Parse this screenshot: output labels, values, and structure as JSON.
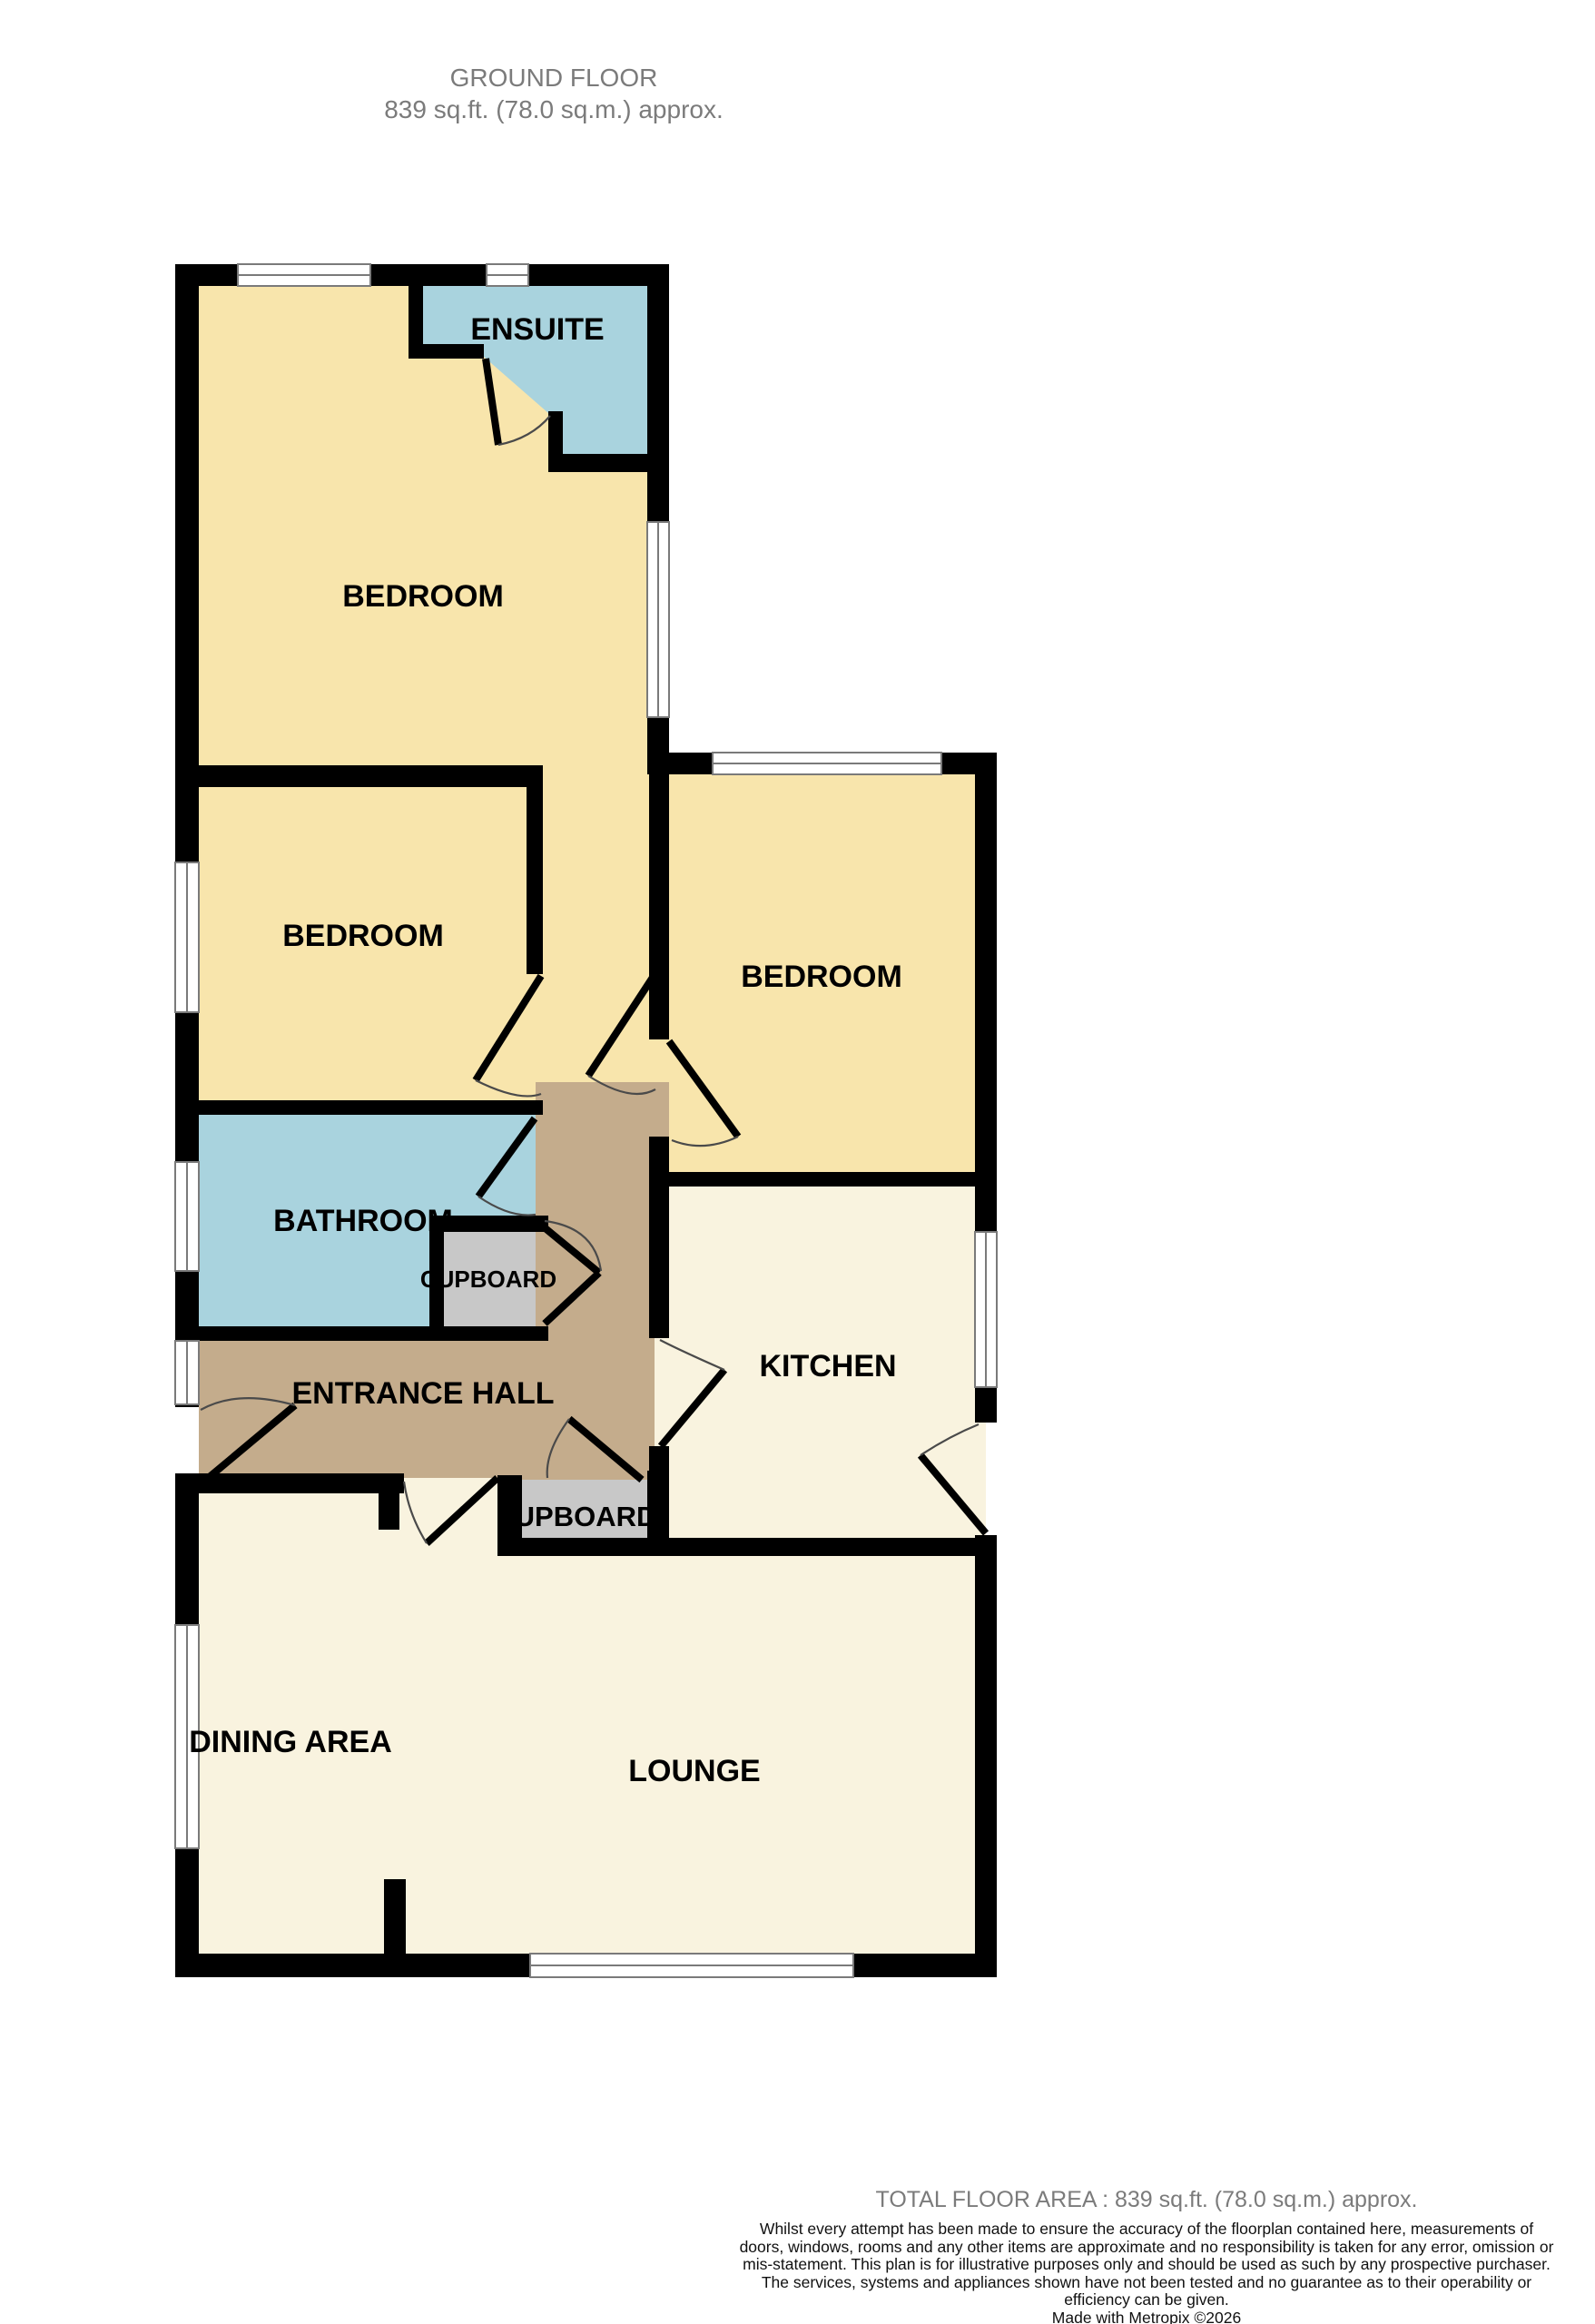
{
  "title": {
    "line1": "GROUND FLOOR",
    "line2": "839 sq.ft. (78.0 sq.m.) approx."
  },
  "rooms": {
    "ensuite": "ENSUITE",
    "bedroom1": "BEDROOM",
    "bedroom2": "BEDROOM",
    "bedroom3": "BEDROOM",
    "bathroom": "BATHROOM",
    "cupboard1": "CUPBOARD",
    "entrance_hall": "ENTRANCE HALL",
    "kitchen": "KITCHEN",
    "cupboard2": "UPBOARD",
    "dining": "DINING AREA",
    "lounge": "LOUNGE"
  },
  "footer": {
    "total": "TOTAL FLOOR AREA : 839 sq.ft. (78.0 sq.m.) approx.",
    "disclaimer": "Whilst every attempt has been made to ensure the accuracy of the floorplan contained here, measurements of doors, windows, rooms and any other items are approximate and no responsibility is taken for any error, omission or mis-statement. This plan is for illustrative purposes only and should be used as such by any prospective purchaser. The services, systems and appliances shown have not been tested and no guarantee as to their operability or efficiency can be given.",
    "made_with": "Made with Metropix ©2026"
  },
  "colors": {
    "wall": "#000000",
    "bedroom": "#F8E5AC",
    "pale": "#F9F3DF",
    "blue": "#A9D3DE",
    "tan": "#C4AC8C",
    "cupboard": "#C8C8C8",
    "window_line": "#7a7a7a",
    "arc": "#4a4a4a",
    "title_text": "#7b7b7b",
    "body_text": "#111111"
  }
}
